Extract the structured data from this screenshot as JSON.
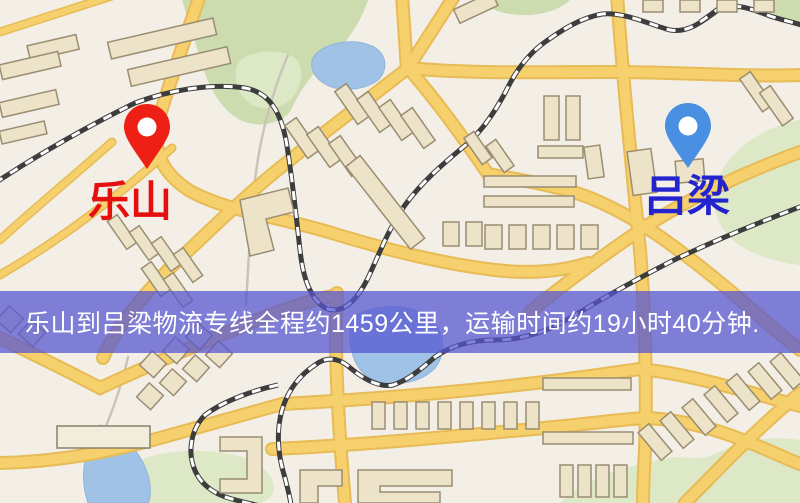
{
  "banner": {
    "text": "乐山到吕梁物流专线全程约1459公里，运输时间约19小时40分钟.",
    "bg_color": "#5656d1",
    "text_color": "#ffffff"
  },
  "markers": {
    "origin": {
      "label": "乐山",
      "label_color": "#e60f0f",
      "pin_color": "#ee2015"
    },
    "destination": {
      "label": "吕梁",
      "label_color": "#2424cf",
      "pin_color": "#4a90e2"
    }
  },
  "map_colors": {
    "background": "#f3efe7",
    "road": "#f6d06d",
    "road_casing": "#e7bb55",
    "railway": "#3d3d3d",
    "building": "#ece3c9",
    "building_outline": "#9a8d72",
    "green": "#ccdcaf",
    "water": "#9fc2e6"
  }
}
